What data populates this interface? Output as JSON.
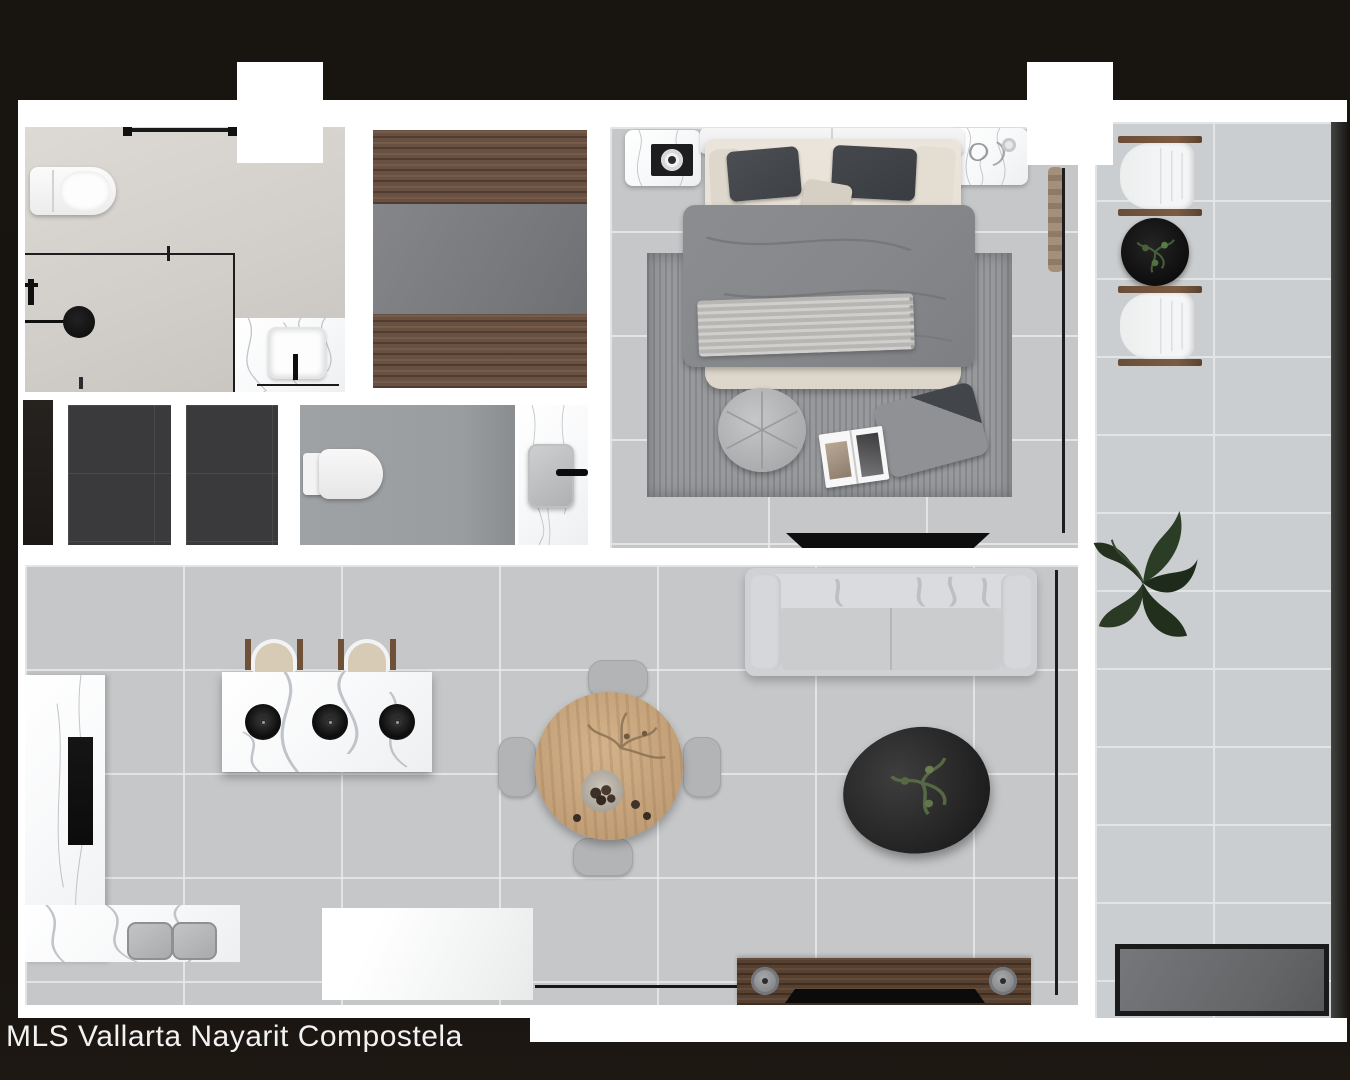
{
  "watermark": "MLS Vallarta Nayarit Compostela",
  "plan_type": "apartment-floor-plan-top-down-3d-render",
  "rooms": {
    "bathroom": {
      "items": [
        "towel-bar",
        "toilet",
        "shower-glass-enclosure",
        "shower-head",
        "shower-mixer",
        "floor-drain",
        "marble-vanity",
        "square-sink",
        "black-faucet"
      ]
    },
    "walk_in_closet": {
      "items": [
        "wood-upper-shelf",
        "gray-hanging-panel",
        "wood-lower-shelf"
      ]
    },
    "hallway": {
      "items": [
        "dark-door-panel",
        "storage-closet-1",
        "storage-closet-2"
      ]
    },
    "powder_room": {
      "items": [
        "toilet",
        "marble-vanity",
        "gray-basin",
        "black-faucet"
      ]
    },
    "bedroom": {
      "items": [
        "headboard",
        "double-bed",
        "dark-pillows",
        "gray-duvet",
        "knit-throw",
        "marble-nightstand-left",
        "camera-decor",
        "marble-nightstand-right",
        "area-rug",
        "round-pouf",
        "floor-cushion",
        "open-magazine",
        "wall-tv",
        "curtain",
        "glass-wall"
      ]
    },
    "kitchen": {
      "items": [
        "l-shaped-counter",
        "black-cooktop",
        "double-gray-sink",
        "marble-island",
        "three-burners",
        "bar-stool-1",
        "bar-stool-2",
        "entry-landing"
      ]
    },
    "dining": {
      "items": [
        "round-wood-table",
        "dry-branches-centerpiece",
        "fruit-bowl",
        "chair-north",
        "chair-south",
        "chair-west",
        "chair-east"
      ]
    },
    "living": {
      "items": [
        "light-gray-sofa",
        "black-pebble-coffee-table",
        "plant-sprig",
        "wood-media-console",
        "speaker-left",
        "speaker-right",
        "flat-tv",
        "entry-threshold",
        "glass-wall"
      ]
    },
    "balcony": {
      "items": [
        "lounge-chair-1",
        "black-side-table",
        "potted-plant",
        "lounge-chair-2",
        "large-floor-plant",
        "dark-outdoor-mat",
        "glass-railing"
      ]
    }
  },
  "colors": {
    "background": "#16120f",
    "walls": "#ffffff",
    "floor_tile": "#c5c7c9",
    "balcony_tile": "#cbced0",
    "dark_tile": "#3a3a3c",
    "closet_wood": "#6a5040",
    "table_wood": "#c9a87e",
    "marble": "#ffffff",
    "accent_black": "#141414",
    "watermark_text": "#f2f2f2"
  }
}
